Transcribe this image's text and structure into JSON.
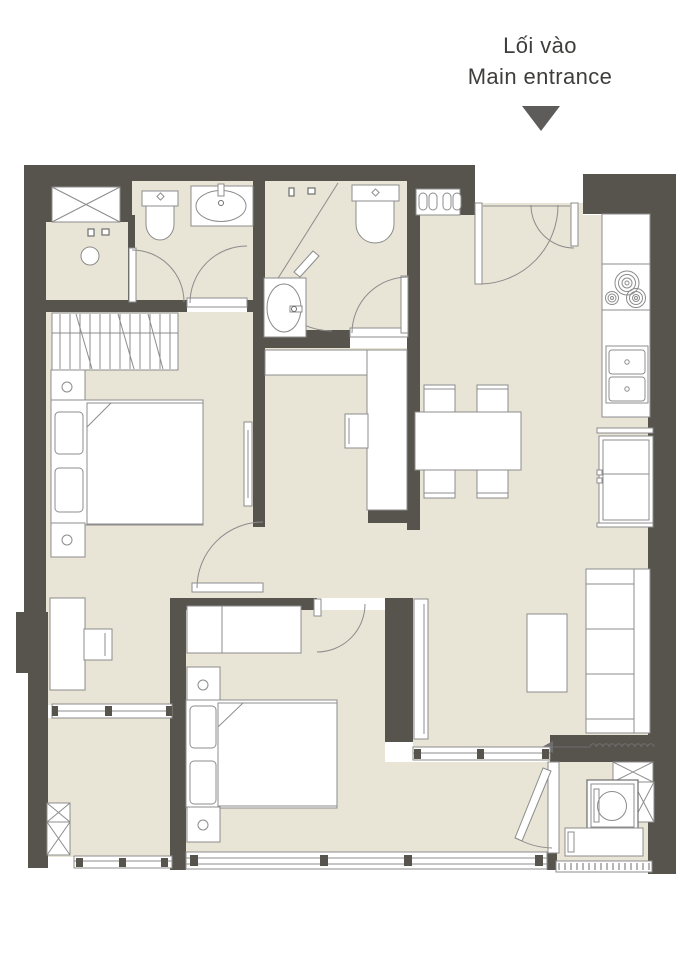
{
  "header": {
    "label_vi": "Lối vào",
    "label_en": "Main entrance"
  },
  "colors": {
    "wall": "#57534d",
    "floor": "#e8e4d6",
    "line": "#8c8c8c",
    "line_dark": "#6e6e6e",
    "text": "#3f3e3c",
    "arrow": "#5d5c5a",
    "bg": "#ffffff"
  }
}
